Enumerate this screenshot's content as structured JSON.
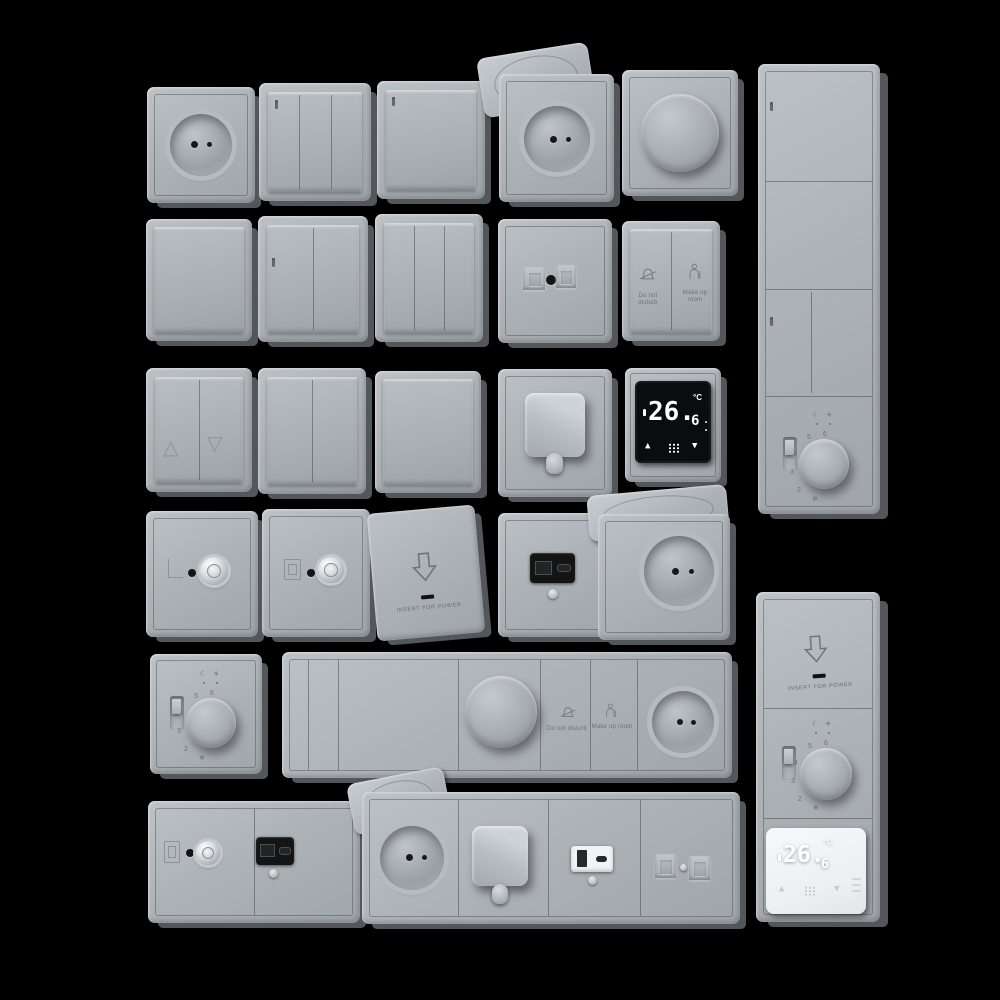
{
  "colors": {
    "background": "#000000",
    "plate": "#adb2b7",
    "plate_side": "#53565a",
    "module_black": "#141415",
    "screen_black": "#0b0c0d",
    "thermostat_white_body": "#f0f2f3",
    "display_digits": "#ffffff"
  },
  "hotel_switch": {
    "dnd_label": "Do not disturb",
    "mur_label": "Make up room"
  },
  "keycard": {
    "label": "INSERT FOR POWER"
  },
  "digital_thermostat": {
    "value": "26.",
    "decimal": "6",
    "unit": "°C",
    "up_icon": "▲",
    "down_icon": "▼"
  },
  "dial_thermostat": {
    "numbers": [
      "6",
      "5",
      "4",
      "3",
      "2"
    ],
    "frost_icon": "❄",
    "night_icon": "☾",
    "day_icon": "☀"
  },
  "shutter_switch": {
    "up_icon": "△",
    "down_icon": "▽"
  }
}
